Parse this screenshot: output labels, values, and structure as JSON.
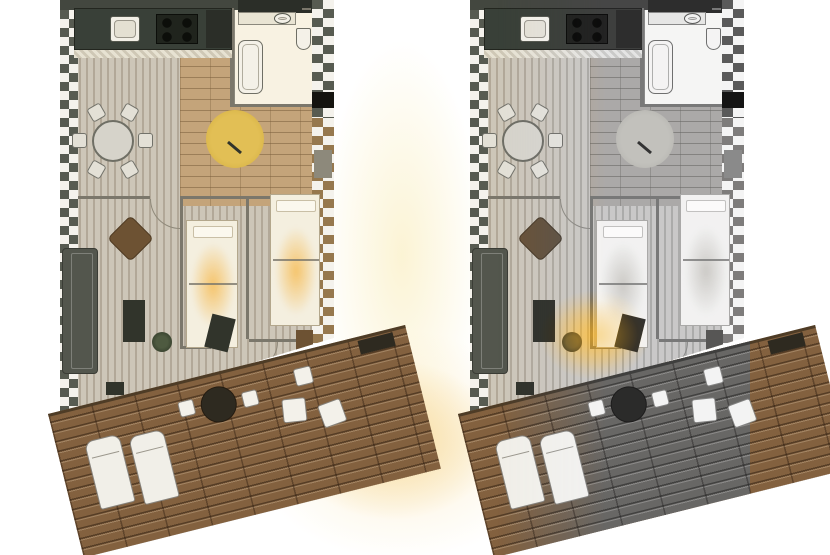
{
  "canvas": {
    "width": 830,
    "height": 555
  },
  "palette": {
    "wall_dark": "#43473f",
    "wall_darker": "#2b2e28",
    "counter_dark": "#394038",
    "appliance_dark": "#20241d",
    "wall_line": "#7b776b",
    "rug_yellow": "#ddb84e",
    "sofa_gray": "#53564d",
    "wood_brown": "#6d5233",
    "cabinet_dark": "#31342b",
    "deck_brown": "#83613f",
    "deck_edge": "#4e3c26",
    "planter_dark": "#2e2a20",
    "door_black": "#15140f",
    "radiator_gray": "#8d897b",
    "bath_floor": "#f8f2e2",
    "plank_light": "#cdc6b8",
    "plank_dark": "#b2a898",
    "brick_tan": "#c4a47a",
    "checker_dark": "#575b51",
    "checker_tan": "#96784e",
    "furniture_white": "#f2f0e9",
    "glow_warm": "#f6d694",
    "glow_pale": "#fbf3d2"
  },
  "background_glows": [
    {
      "n": "gap-pale-glow",
      "x": 322,
      "y": 40,
      "w": 160,
      "h": 430,
      "color": "rgba(251,243,210,0.95)"
    },
    {
      "n": "terrace-warm-glow",
      "x": 288,
      "y": 360,
      "w": 210,
      "h": 160,
      "color": "rgba(246,214,148,1)"
    },
    {
      "n": "terrace-warm-glow-soft",
      "x": 250,
      "y": 330,
      "w": 300,
      "h": 230,
      "color": "rgba(250,230,180,0.55)"
    }
  ],
  "plans": [
    {
      "name": "floorplan-color",
      "x": 60,
      "variant": "color"
    },
    {
      "name": "floorplan-grayscale",
      "x": 470,
      "variant": "grayscale",
      "color_spots": [
        {
          "n": "lamp-color-spot",
          "c": "spot-color",
          "x": 70,
          "y": 290,
          "w": 110,
          "h": 90
        },
        {
          "n": "lamp-light-spot",
          "c": "spot-light",
          "x": 82,
          "y": 300,
          "w": 86,
          "h": 70
        }
      ]
    }
  ],
  "plan_template": {
    "width": 280,
    "height": 555,
    "items": [
      {
        "n": "apartment-interior",
        "c": "interior",
        "x": 0,
        "y": 0,
        "w": 280,
        "h": 430,
        "children": [
          {
            "n": "living-floor-planks",
            "c": "floor-planks",
            "x": 14,
            "y": 44,
            "w": 242,
            "h": 380
          },
          {
            "n": "dining-floor-brick",
            "c": "floor-brick",
            "x": 120,
            "y": 44,
            "w": 136,
            "h": 162
          },
          {
            "n": "bathroom-floor",
            "c": "floor-bath",
            "x": 174,
            "y": 8,
            "w": 82,
            "h": 98,
            "bg": "bath_floor"
          },
          {
            "n": "top-wall",
            "x": 0,
            "y": 0,
            "w": 180,
            "h": 10,
            "bg": "wall_dark"
          },
          {
            "n": "top-wall-bathroom",
            "x": 178,
            "y": 0,
            "w": 78,
            "h": 13,
            "bg": "wall_darker"
          },
          {
            "n": "left-exterior-wall",
            "c": "checker-dark",
            "x": 0,
            "y": 10,
            "w": 18,
            "h": 414
          },
          {
            "n": "right-exterior-wall-upper",
            "c": "checker-dark",
            "x": 252,
            "y": 0,
            "w": 22,
            "h": 118
          },
          {
            "n": "right-exterior-wall-lower",
            "c": "checker-tan",
            "x": 252,
            "y": 118,
            "w": 22,
            "h": 228
          },
          {
            "n": "bathroom-wall-left",
            "x": 170,
            "y": 8,
            "w": 4,
            "h": 99,
            "bg": "wall_line"
          },
          {
            "n": "bathroom-wall-bottom",
            "x": 174,
            "y": 104,
            "w": 82,
            "h": 3,
            "bg": "wall_line"
          },
          {
            "n": "hall-wall-left-segment",
            "x": 18,
            "y": 196,
            "w": 72,
            "h": 3,
            "bg": "wall_line"
          },
          {
            "n": "hall-wall-right-segment",
            "x": 120,
            "y": 196,
            "w": 132,
            "h": 3,
            "bg": "wall_line"
          },
          {
            "n": "bedroom-wall-1",
            "x": 120,
            "y": 199,
            "w": 3,
            "h": 150,
            "bg": "wall_line"
          },
          {
            "n": "bedroom-wall-2",
            "x": 186,
            "y": 199,
            "w": 3,
            "h": 140,
            "bg": "wall_line"
          },
          {
            "n": "bedroom1-wall-bottom",
            "x": 123,
            "y": 346,
            "w": 28,
            "h": 3,
            "bg": "wall_line"
          },
          {
            "n": "bedroom2-wall-bottom",
            "x": 189,
            "y": 339,
            "w": 63,
            "h": 3,
            "bg": "wall_line"
          },
          {
            "n": "kitchen-counter",
            "c": "counter",
            "x": 14,
            "y": 8,
            "w": 158,
            "h": 42,
            "bg": "counter_dark"
          },
          {
            "n": "kitchen-sink",
            "c": "sink",
            "x": 50,
            "y": 16,
            "w": 30,
            "h": 26
          },
          {
            "n": "kitchen-stove",
            "c": "stove",
            "x": 96,
            "y": 14,
            "w": 42,
            "h": 30
          },
          {
            "n": "kitchen-fridge",
            "x": 146,
            "y": 10,
            "w": 26,
            "h": 38,
            "bg": "wall_darker"
          },
          {
            "n": "kitchen-counter-hatch",
            "c": "hatch",
            "x": 14,
            "y": 50,
            "w": 158,
            "h": 8
          },
          {
            "n": "bathroom-vanity",
            "c": "vanity",
            "x": 178,
            "y": 12,
            "w": 58,
            "h": 13
          },
          {
            "n": "bathroom-sink",
            "c": "sink round",
            "x": 214,
            "y": 13,
            "w": 17,
            "h": 11
          },
          {
            "n": "bathroom-faucet-icon",
            "x": 242,
            "y": 8,
            "w": 9,
            "h": 2,
            "bg": "wall_line"
          },
          {
            "n": "toilet",
            "c": "toilet",
            "x": 236,
            "y": 28,
            "w": 15,
            "h": 22
          },
          {
            "n": "bathtub",
            "c": "tub",
            "x": 178,
            "y": 40,
            "w": 25,
            "h": 54
          },
          {
            "n": "dining-table",
            "c": "table-round",
            "x": 32,
            "y": 120,
            "w": 42,
            "h": 42
          },
          {
            "n": "dining-chair",
            "c": "chair",
            "x": 78,
            "y": 133,
            "w": 15,
            "h": 15,
            "rot": 90
          },
          {
            "n": "dining-chair",
            "c": "chair",
            "x": 62,
            "y": 162,
            "w": 15,
            "h": 15,
            "rot": 60
          },
          {
            "n": "dining-chair",
            "c": "chair",
            "x": 29,
            "y": 162,
            "w": 15,
            "h": 15,
            "rot": -60
          },
          {
            "n": "dining-chair",
            "c": "chair",
            "x": 12,
            "y": 133,
            "w": 15,
            "h": 15,
            "rot": 90
          },
          {
            "n": "dining-chair",
            "c": "chair",
            "x": 29,
            "y": 105,
            "w": 15,
            "h": 15,
            "rot": 60
          },
          {
            "n": "dining-chair",
            "c": "chair",
            "x": 62,
            "y": 105,
            "w": 15,
            "h": 15,
            "rot": -60
          },
          {
            "n": "round-area-rug",
            "c": "rug",
            "x": 146,
            "y": 110,
            "w": 58,
            "h": 58
          },
          {
            "n": "floor-lamp-icon",
            "x": 166,
            "y": 146,
            "w": 17,
            "h": 3,
            "rot": 40,
            "bg": "cabinet_dark"
          },
          {
            "n": "sofa",
            "c": "sofa",
            "x": 2,
            "y": 248,
            "w": 36,
            "h": 126,
            "bg": "sofa_gray"
          },
          {
            "n": "armchair",
            "c": "armchair",
            "x": 54,
            "y": 222,
            "w": 33,
            "h": 33,
            "rot": 45,
            "bg": "wood_brown"
          },
          {
            "n": "tv-cabinet",
            "x": 63,
            "y": 300,
            "w": 22,
            "h": 42,
            "bg": "cabinet_dark"
          },
          {
            "n": "side-table",
            "x": 46,
            "y": 382,
            "w": 18,
            "h": 13,
            "bg": "cabinet_dark"
          },
          {
            "n": "potted-plant",
            "c": "plant",
            "x": 92,
            "y": 332,
            "w": 20,
            "h": 20
          },
          {
            "n": "bed-twin-1",
            "c": "bed",
            "x": 126,
            "y": 220,
            "w": 52,
            "h": 128,
            "children": [
              {
                "n": "bed-glow",
                "c": "bed-glow",
                "x": 4,
                "y": 22,
                "w": 44,
                "h": 84
              },
              {
                "n": "bed-pillow",
                "c": "pillow",
                "x": 6,
                "y": 5,
                "w": 40,
                "h": 12
              },
              {
                "n": "bed-divider",
                "c": "line2",
                "x": 2,
                "y": 62,
                "w": 48,
                "h": 2,
                "bg": "wall_line"
              }
            ]
          },
          {
            "n": "bed-twin-2",
            "c": "bed",
            "x": 210,
            "y": 194,
            "w": 50,
            "h": 132,
            "children": [
              {
                "n": "bed-glow",
                "c": "bed-glow",
                "x": 4,
                "y": 32,
                "w": 42,
                "h": 88
              },
              {
                "n": "bed-pillow",
                "c": "pillow",
                "x": 5,
                "y": 5,
                "w": 40,
                "h": 12
              },
              {
                "n": "bed-divider",
                "c": "line2",
                "x": 2,
                "y": 64,
                "w": 46,
                "h": 2,
                "bg": "wall_line"
              }
            ]
          },
          {
            "n": "wardrobe",
            "x": 236,
            "y": 330,
            "w": 17,
            "h": 46,
            "bg": "wood_brown"
          },
          {
            "n": "desk-and-chair",
            "x": 148,
            "y": 316,
            "w": 24,
            "h": 34,
            "rot": 14,
            "bg": "cabinet_dark"
          },
          {
            "n": "door-swing-arc",
            "c": "door-arc",
            "x": 90,
            "y": 199,
            "w": 30,
            "h": 30
          },
          {
            "n": "door-swing-arc",
            "c": "door-arc",
            "x": 190,
            "y": 342,
            "w": 28,
            "h": 28,
            "rot": -90
          },
          {
            "n": "balcony-door",
            "x": 252,
            "y": 92,
            "w": 22,
            "h": 16,
            "bg": "door_black"
          },
          {
            "n": "radiator",
            "x": 254,
            "y": 150,
            "w": 18,
            "h": 28,
            "bg": "radiator_gray"
          }
        ]
      },
      {
        "n": "terrace-deck",
        "c": "deck",
        "x": -12,
        "y": 414,
        "w": 368,
        "h": 148,
        "rot": -14,
        "children": [
          {
            "n": "deck-edge",
            "x": 0,
            "y": 0,
            "w": 368,
            "h": 3,
            "bg": "deck_edge"
          },
          {
            "n": "sun-lounger",
            "c": "lounger",
            "x": 28,
            "y": 36,
            "w": 36,
            "h": 70
          },
          {
            "n": "sun-lounger",
            "c": "lounger",
            "x": 72,
            "y": 42,
            "w": 36,
            "h": 70
          },
          {
            "n": "deck-round-table",
            "c": "deck-table",
            "x": 150,
            "y": 14,
            "w": 36,
            "h": 36,
            "bg": "planter_dark"
          },
          {
            "n": "deck-chair",
            "c": "chair-white",
            "x": 128,
            "y": 20,
            "w": 16,
            "h": 16
          },
          {
            "n": "deck-chair",
            "c": "chair-white",
            "x": 192,
            "y": 26,
            "w": 16,
            "h": 16
          },
          {
            "n": "deck-side-table",
            "c": "chair-white",
            "x": 248,
            "y": 16,
            "w": 18,
            "h": 18
          },
          {
            "n": "deck-square-chair",
            "c": "chair-white",
            "x": 228,
            "y": 44,
            "w": 24,
            "h": 24,
            "rot": 8
          },
          {
            "n": "deck-square-chair",
            "c": "chair-white",
            "x": 264,
            "y": 56,
            "w": 24,
            "h": 24,
            "rot": -6
          },
          {
            "n": "planter-box",
            "x": 318,
            "y": 4,
            "w": 36,
            "h": 14,
            "bg": "planter_dark"
          }
        ]
      }
    ]
  }
}
